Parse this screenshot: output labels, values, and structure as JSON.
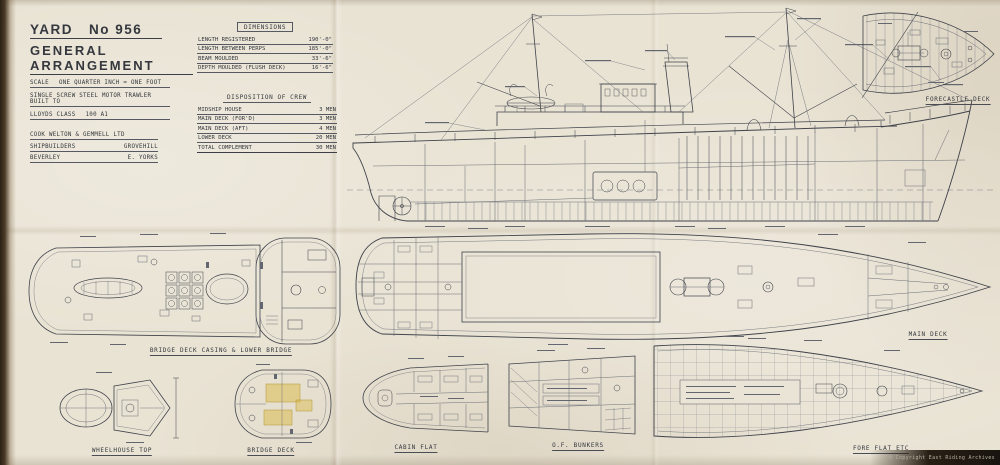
{
  "colors": {
    "paper": "#e9e3d4",
    "ink": "#3c3f45",
    "highlight": "#d9b945"
  },
  "title_block": {
    "yard_label": "YARD",
    "yard_no": "No 956",
    "title": "GENERAL ARRANGEMENT",
    "scale_label": "SCALE",
    "scale_value": "ONE QUARTER INCH = ONE FOOT",
    "type_line": "SINGLE SCREW STEEL MOTOR TRAWLER BUILT TO",
    "class_label": "LLOYDS CLASS",
    "class_value": "100 A1",
    "builder_name": "COOK WELTON & GEMMELL LTD",
    "builder_role": "SHIPBUILDERS",
    "builder_place": "GROVEHILL",
    "builder_town": "BEVERLEY",
    "builder_county": "E. YORKS"
  },
  "dimensions": {
    "title": "DIMENSIONS",
    "rows": [
      {
        "label": "LENGTH REGISTERED",
        "value": "190'-0\""
      },
      {
        "label": "LENGTH BETWEEN PERPS",
        "value": "185'-0\""
      },
      {
        "label": "BEAM MOULDED",
        "value": "33'-6\""
      },
      {
        "label": "DEPTH MOULDED (FLUSH DECK)",
        "value": "16'-6\""
      }
    ]
  },
  "crew": {
    "title": "DISPOSITION OF CREW",
    "rows": [
      {
        "label": "MIDSHIP HOUSE",
        "value": "3 MEN"
      },
      {
        "label": "MAIN DECK (FOR'D)",
        "value": "3 MEN"
      },
      {
        "label": "MAIN DECK (AFT)",
        "value": "4 MEN"
      },
      {
        "label": "LOWER DECK",
        "value": "20 MEN"
      },
      {
        "label": "TOTAL COMPLEMENT",
        "value": "30 MEN"
      }
    ]
  },
  "captions": {
    "forecastle_deck": "FORECASTLE DECK",
    "bridge_casing": "BRIDGE DECK CASING & LOWER BRIDGE",
    "main_deck": "MAIN DECK",
    "wheelhouse_top": "WHEELHOUSE TOP",
    "bridge_deck": "BRIDGE DECK",
    "cabin_flat": "CABIN FLAT",
    "of_bunkers": "O.F. BUNKERS",
    "fore_flat": "FORE FLAT ETC"
  },
  "footer": {
    "copyright": "© Copyright East Riding Archives"
  }
}
